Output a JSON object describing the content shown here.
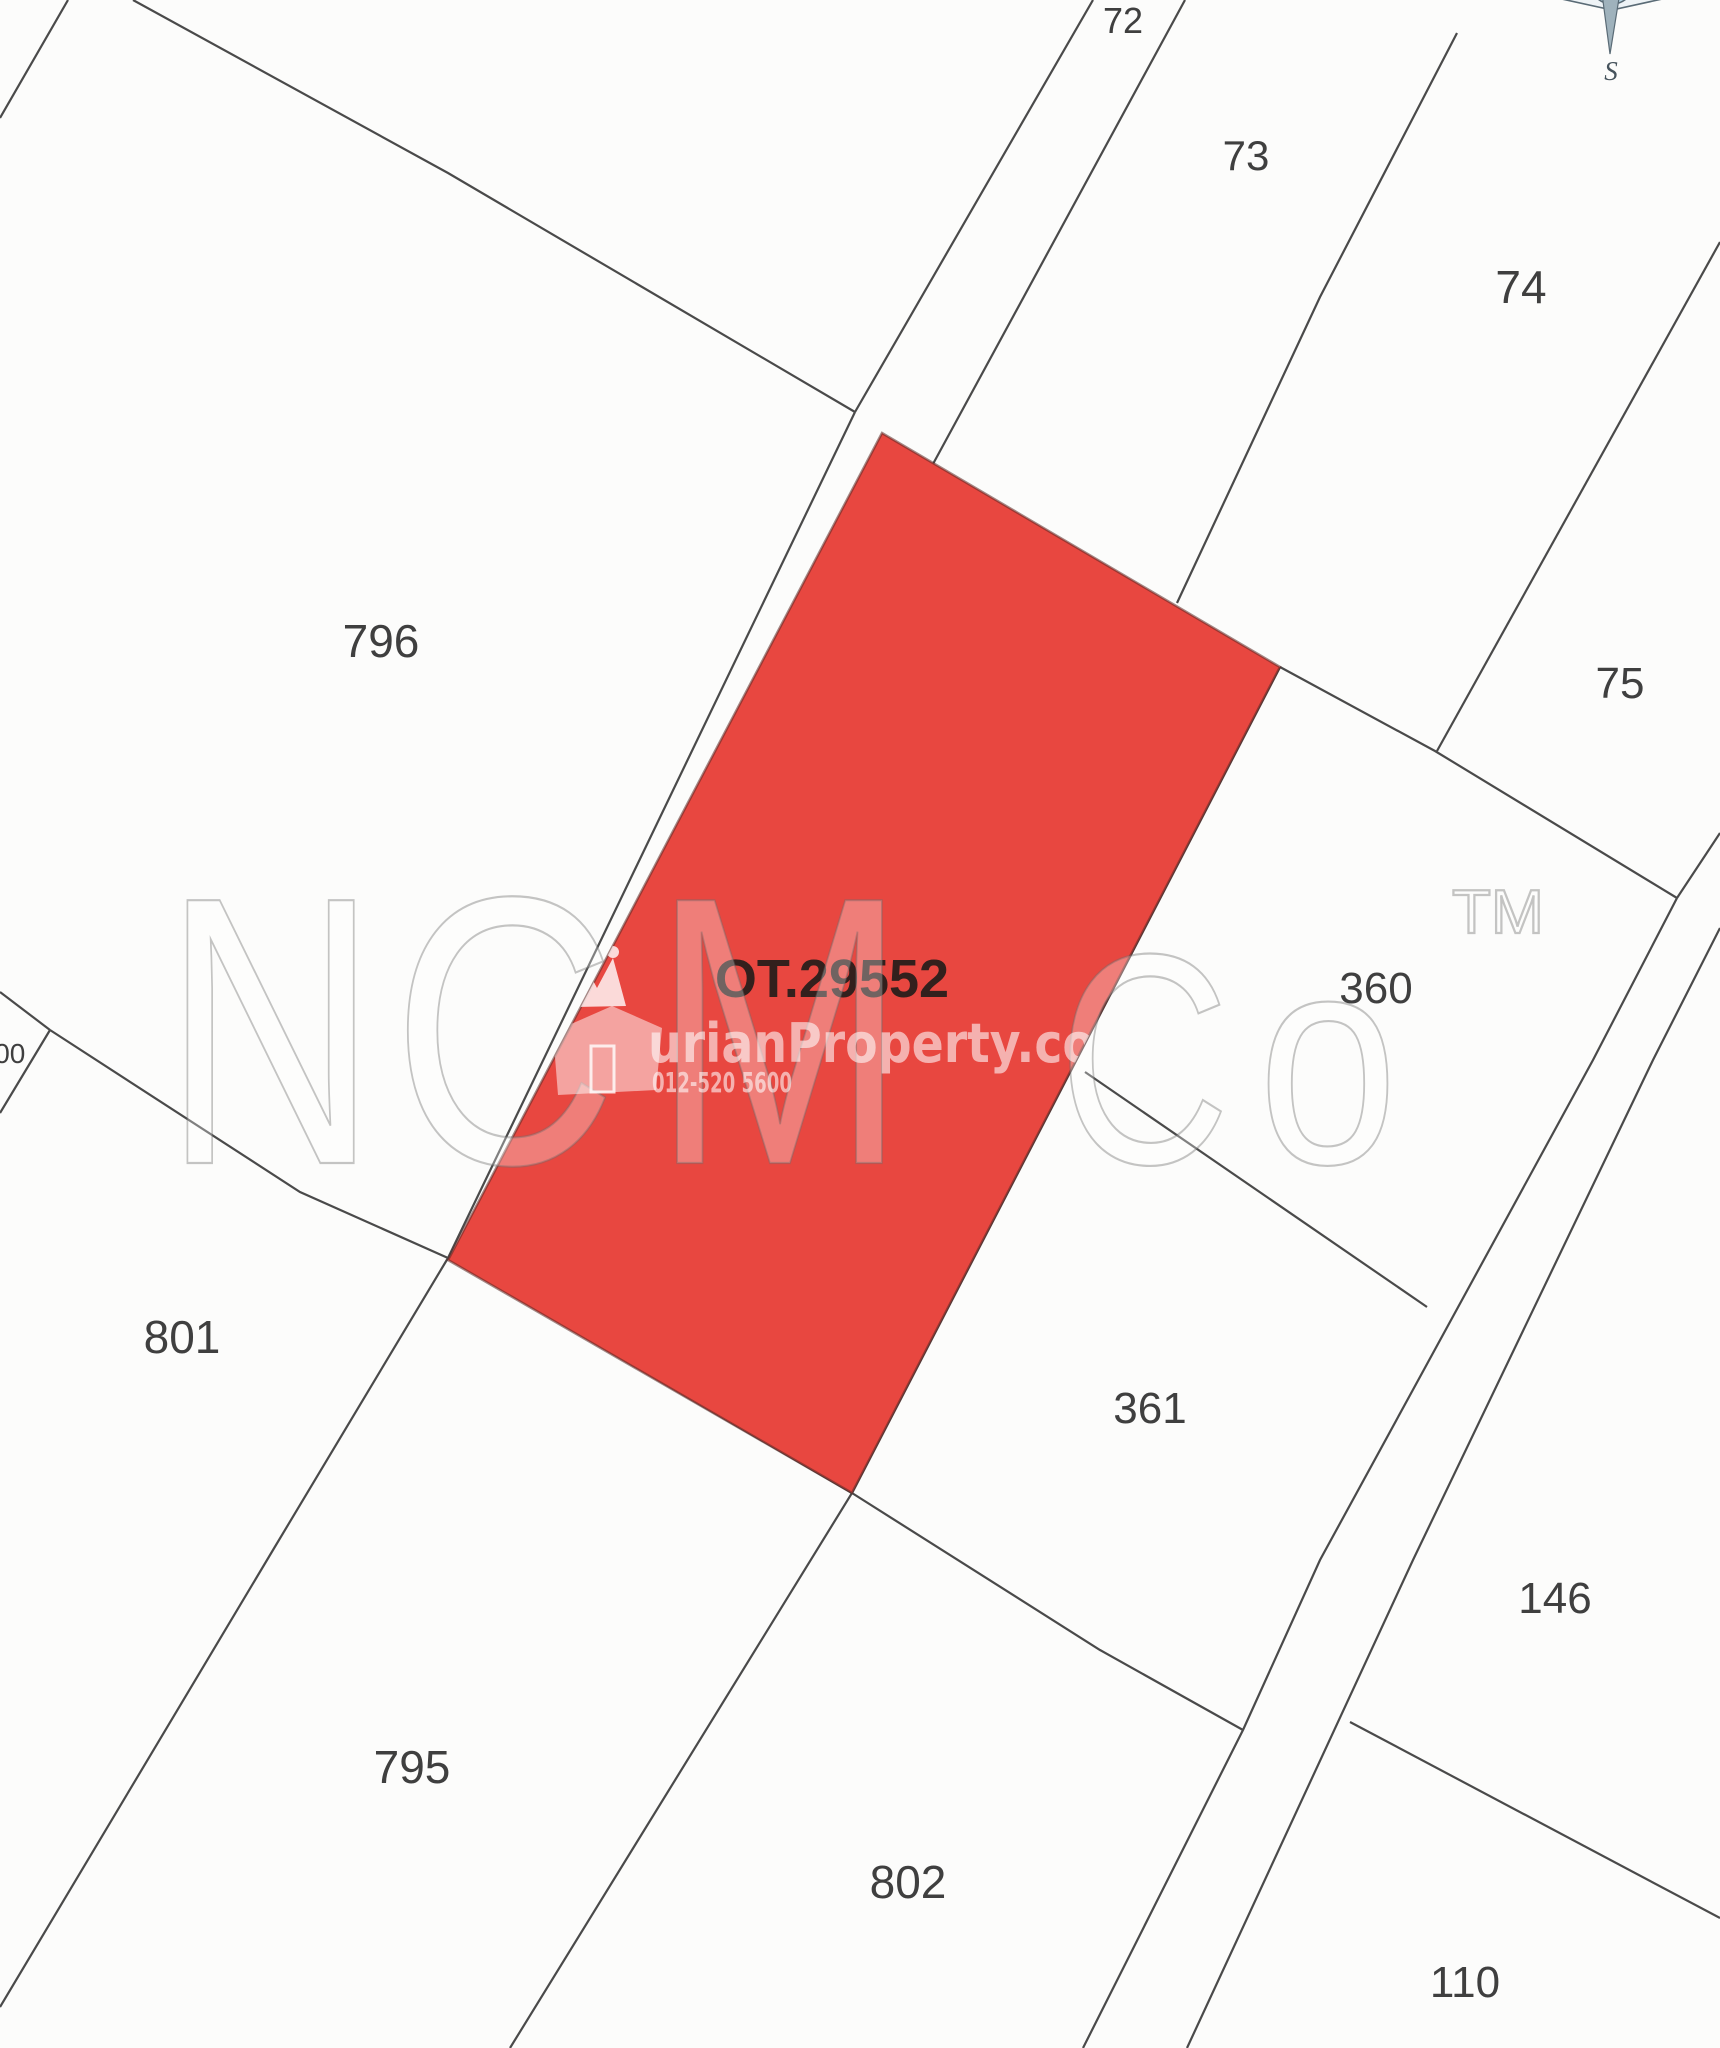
{
  "map": {
    "background_color": "#fcfcfb",
    "boundary_color": "#4a4a4a",
    "label_color": "#3f3f3f",
    "parcels": [
      {
        "label": "72",
        "x": 1123,
        "y": 33,
        "size": 36
      },
      {
        "label": "73",
        "x": 1246,
        "y": 170,
        "size": 42
      },
      {
        "label": "74",
        "x": 1521,
        "y": 303,
        "size": 46
      },
      {
        "label": "75",
        "x": 1620,
        "y": 698,
        "size": 44
      },
      {
        "label": "796",
        "x": 381,
        "y": 657,
        "size": 46
      },
      {
        "label": "800",
        "x": 2,
        "y": 1063,
        "size": 28
      },
      {
        "label": "801",
        "x": 182,
        "y": 1353,
        "size": 46
      },
      {
        "label": "360",
        "x": 1376,
        "y": 1003,
        "size": 44
      },
      {
        "label": "361",
        "x": 1150,
        "y": 1423,
        "size": 44
      },
      {
        "label": "146",
        "x": 1555,
        "y": 1613,
        "size": 44
      },
      {
        "label": "110",
        "x": 1465,
        "y": 1997,
        "size": 44
      },
      {
        "label": "795",
        "x": 412,
        "y": 1783,
        "size": 46
      },
      {
        "label": "802",
        "x": 908,
        "y": 1898,
        "size": 46
      }
    ],
    "boundaries": [
      [
        [
          68,
          0
        ],
        [
          0,
          118
        ]
      ],
      [
        [
          133,
          0
        ],
        [
          448,
          173
        ],
        [
          855,
          412
        ]
      ],
      [
        [
          1093,
          0
        ],
        [
          855,
          412
        ]
      ],
      [
        [
          855,
          412
        ],
        [
          448,
          1258
        ]
      ],
      [
        [
          1185,
          0
        ],
        [
          933,
          464
        ]
      ],
      [
        [
          1457,
          33
        ],
        [
          1320,
          297
        ],
        [
          1177,
          603
        ]
      ],
      [
        [
          1720,
          242
        ],
        [
          1437,
          751
        ]
      ],
      [
        [
          1280,
          667
        ],
        [
          1435,
          751
        ],
        [
          1677,
          898
        ]
      ],
      [
        [
          1720,
          833
        ],
        [
          1677,
          898
        ]
      ],
      [
        [
          1677,
          898
        ],
        [
          1593,
          1060
        ],
        [
          1320,
          1560
        ],
        [
          1243,
          1730
        ],
        [
          1083,
          2048
        ]
      ],
      [
        [
          1720,
          928
        ],
        [
          1653,
          1060
        ],
        [
          1413,
          1560
        ],
        [
          1187,
          2048
        ]
      ],
      [
        [
          1085,
          1072
        ],
        [
          1427,
          1307
        ]
      ],
      [
        [
          0,
          992
        ],
        [
          50,
          1030
        ]
      ],
      [
        [
          50,
          1030
        ],
        [
          300,
          1192
        ],
        [
          448,
          1258
        ]
      ],
      [
        [
          0,
          1113
        ],
        [
          50,
          1030
        ]
      ],
      [
        [
          448,
          1258
        ],
        [
          273,
          1550
        ],
        [
          0,
          2007
        ]
      ],
      [
        [
          448,
          1258
        ],
        [
          852,
          1493
        ]
      ],
      [
        [
          852,
          1493
        ],
        [
          1100,
          1650
        ],
        [
          1243,
          1730
        ]
      ],
      [
        [
          1280,
          667
        ],
        [
          852,
          1493
        ],
        [
          510,
          2048
        ]
      ],
      [
        [
          1350,
          1722
        ],
        [
          1720,
          1918
        ]
      ]
    ],
    "highlighted_parcel": {
      "label": "OT.29552",
      "label_x": 832,
      "label_y": 997,
      "label_size": 54,
      "fill_color": "#e84740",
      "edge_color": "rgba(90,40,36,0.55)",
      "points": [
        [
          882,
          433
        ],
        [
          1280,
          667
        ],
        [
          852,
          1493
        ],
        [
          448,
          1260
        ]
      ]
    }
  },
  "watermarks": {
    "brand_text": "NCM Co",
    "brand_baseline_y": 1163,
    "brand_letters": [
      {
        "ch": "N",
        "x": 163,
        "size": 382,
        "w": 215
      },
      {
        "ch": "C",
        "x": 392,
        "size": 382,
        "w": 225
      },
      {
        "ch": "M",
        "x": 652,
        "size": 382,
        "w": 255
      },
      {
        "ch": "C",
        "x": 1058,
        "size": 300,
        "w": 172
      },
      {
        "ch": "o",
        "x": 1258,
        "size": 300,
        "w": 140
      }
    ],
    "trademark": {
      "text": "TM",
      "x": 1452,
      "y": 933,
      "size": 62,
      "w": 92
    },
    "agency": {
      "site_text": "urianProperty.co",
      "site_x": 648,
      "site_y": 1062,
      "site_size": 54,
      "site_w": 447,
      "phone_text": "012-520 5600",
      "phone_x": 652,
      "phone_y": 1092,
      "phone_size": 28,
      "phone_w": 140
    }
  },
  "compass": {
    "south_label": "S"
  }
}
